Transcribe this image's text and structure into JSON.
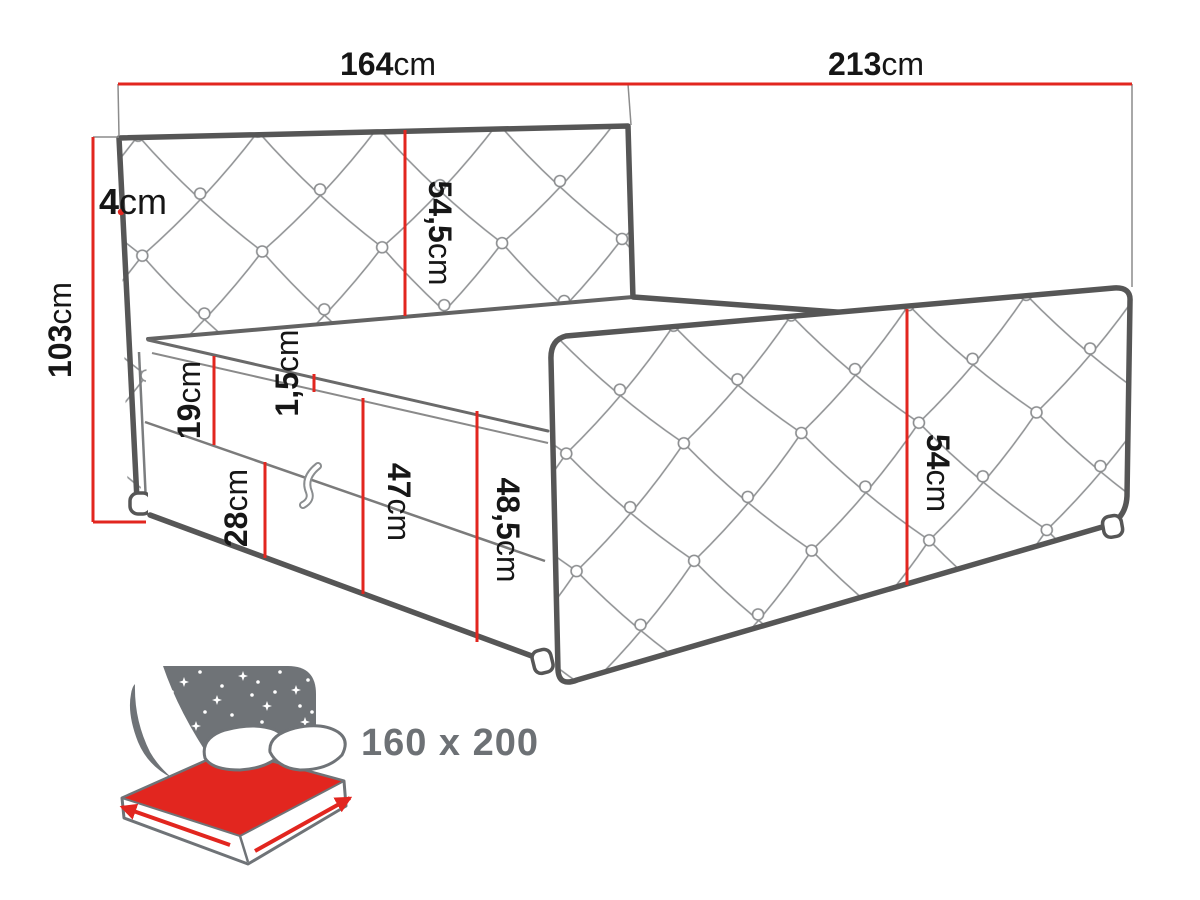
{
  "diagram": {
    "type": "furniture-dimension-drawing",
    "product": "upholstered boxspring bed",
    "dims": {
      "headboard_width": {
        "v": "164",
        "u": "cm"
      },
      "bed_length": {
        "v": "213",
        "u": "cm"
      },
      "headboard_depth": {
        "v": "4",
        "u": "cm"
      },
      "headboard_height": {
        "v": "103",
        "u": "cm"
      },
      "headboard_panel": {
        "v": "54,5",
        "u": "cm"
      },
      "mattress_height": {
        "v": "19",
        "u": "cm"
      },
      "top_lip": {
        "v": "1,5",
        "u": "cm"
      },
      "drawer_height": {
        "v": "28",
        "u": "cm"
      },
      "base_height": {
        "v": "47",
        "u": "cm"
      },
      "side_front_height": {
        "v": "48,5",
        "u": "cm"
      },
      "side_panel_height": {
        "v": "54",
        "u": "cm"
      }
    },
    "badge": {
      "size": "160 x 200"
    },
    "icons": {
      "badge_icon": "double-bed-with-starry-headboard-icon"
    },
    "colors": {
      "dimension_red": "#e2261f",
      "outline_gray": "#565656",
      "quilt_gray": "#909294",
      "icon_gray": "#6f7377",
      "badge_text_gray": "#6d7175",
      "background": "#ffffff"
    }
  }
}
